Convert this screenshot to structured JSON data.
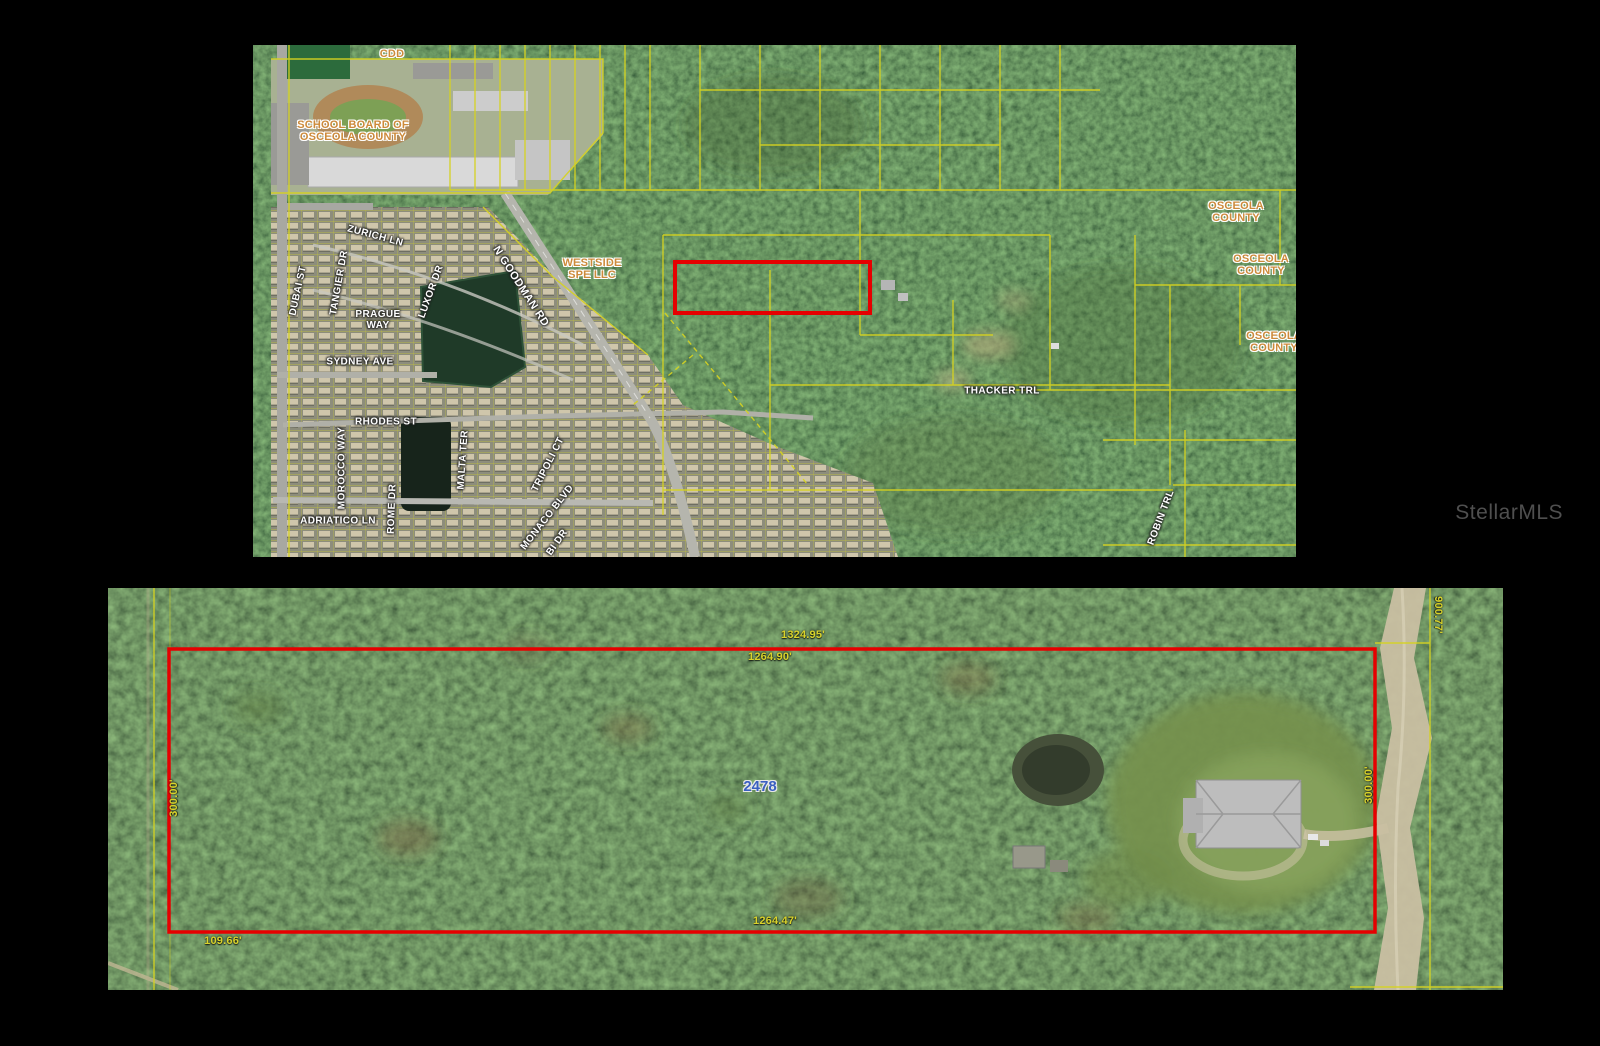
{
  "watermark": "StellarMLS",
  "colors": {
    "parcel_outline": "#e60000",
    "parcel_lines": "#d6d321",
    "dimension_text": "#d9d32b",
    "owner_text": "#cd8a3a",
    "street_text": "#ffffff",
    "parcel_number_text": "#3a5fc0"
  },
  "top_map": {
    "owner_labels": [
      "CDD",
      "SCHOOL BOARD OF\nOSCEOLA COUNTY",
      "WESTSIDE\nSPE LLC",
      "OSCEOLA\nCOUNTY",
      "OSCEOLA\nCOUNTY",
      "OSCEOLA\nCOUNTY"
    ],
    "street_labels": [
      "ZURICH LN",
      "TANGIER DR",
      "DUBAI ST",
      "LUXOR DR",
      "PRAGUE\nWAY",
      "SYDNEY AVE",
      "N GOODMAN RD",
      "RHODES ST",
      "MOROCCO WAY",
      "ROME DR",
      "MALTA TER",
      "TRIPOLI CT",
      "MONACO BLVD",
      "BI DR",
      "ADRIATICO LN",
      "THACKER TRL",
      "ROBIN TRL"
    ]
  },
  "bottom_map": {
    "parcel_number": "2478",
    "dim_top_outer": "1324.95'",
    "dim_top_inner": "1264.90'",
    "dim_bottom": "1264.47'",
    "dim_bottom_left": "109.66'",
    "dim_left_side": "300.00'",
    "dim_right_side": "300.00'",
    "dim_road_right": "900.77'"
  }
}
